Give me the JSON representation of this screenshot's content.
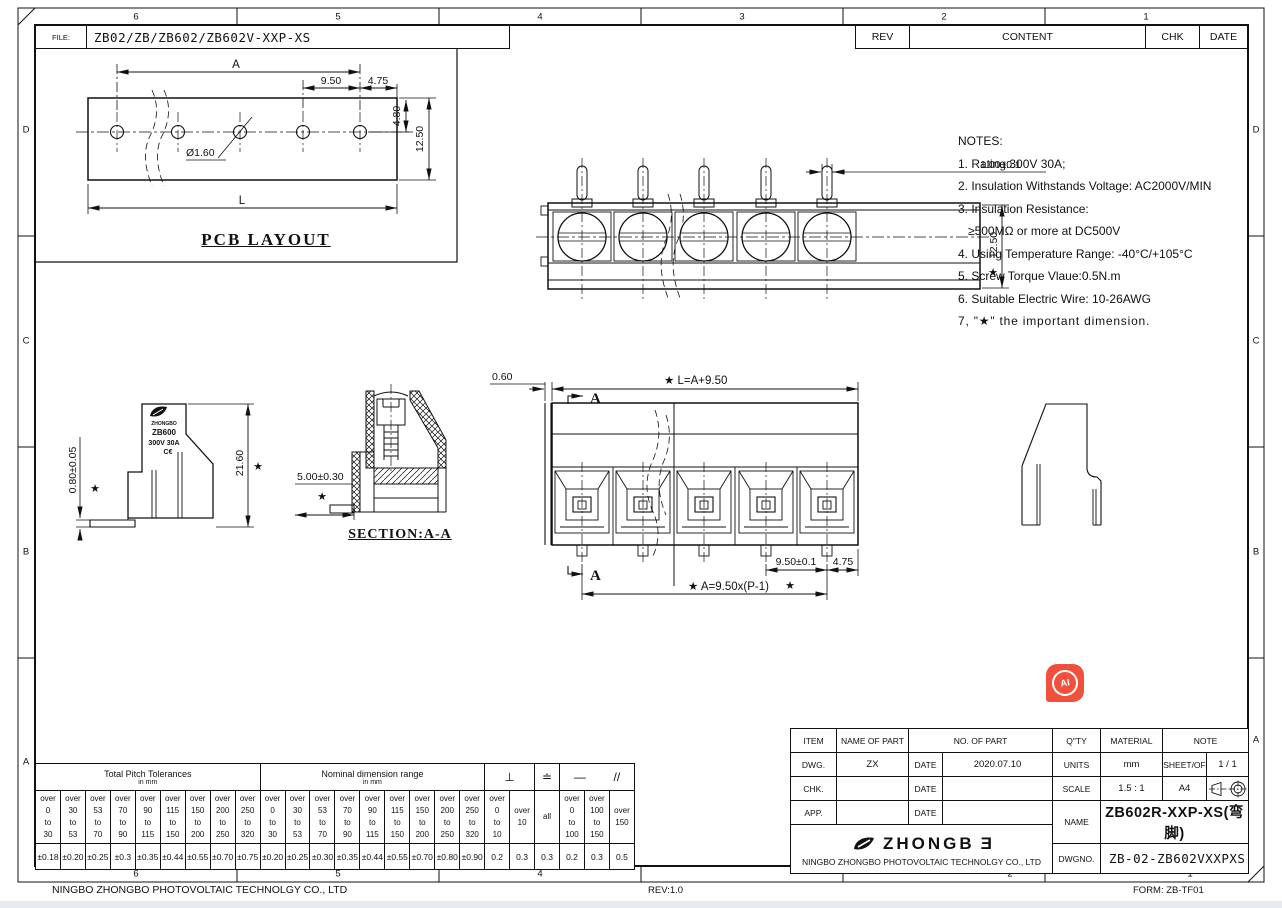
{
  "sheet": {
    "file_label": "FILE:",
    "file_value": "ZB02/ZB/ZB602/ZB602V-XXP-XS",
    "rev": "REV",
    "content": "CONTENT",
    "chk": "CHK",
    "date": "DATE",
    "zone_cols": [
      "6",
      "5",
      "4",
      "3",
      "2",
      "1"
    ],
    "zone_cols_bottom": [
      "6",
      "5",
      "4",
      "2",
      "1"
    ],
    "zone_rows": [
      "D",
      "C",
      "B",
      "A"
    ],
    "footer_company": "NINGBO ZHONGBO PHOTOVOLTAIC TECHNOLGY CO., LTD",
    "footer_rev": "REV:1.0",
    "footer_form": "FORM: ZB-TF01"
  },
  "pcb": {
    "title": "PCB LAYOUT",
    "dim_a": "A",
    "dim_pitch": "9.50",
    "dim_end": "4.75",
    "dim_offset": "4.80",
    "dim_width": "12.50",
    "dim_hole": "Ø1.60",
    "dim_len": "L"
  },
  "top_view": {
    "dim_pin": "1.00±0.1",
    "dim_width": "12.50"
  },
  "side_view": {
    "dim_height": "21.60",
    "dim_pin": "0.80±0.05",
    "dim_offset": "5.00±0.30",
    "brand_name": "ZHONGBO",
    "brand_model": "ZB600",
    "brand_rating": "300V 30A",
    "brand_ce": "C€"
  },
  "section_view": {
    "title": "SECTION:A-A"
  },
  "front_view": {
    "dim_wall": "0.60",
    "dim_len": "★ L=A+9.50",
    "dim_pitch": "9.50±0.1",
    "dim_end": "4.75",
    "dim_formula": "★ A=9.50x(P-1)",
    "mark_a": "A"
  },
  "notes": {
    "title": "NOTES:",
    "n1": "1. Rating:300V 30A;",
    "n2": "2. Insulation Withstands Voltage: AC2000V/MIN",
    "n3": "3. Insulation Resistance:",
    "n3b": "≥500MΩ or more at DC500V",
    "n4": "4. Using Temperature Range: -40°C/+105°C",
    "n5": "5. Screw Torque Vlaue:0.5N.m",
    "n6": "6. Suitable Electric Wire: 10-26AWG",
    "n7": "7, \"★\" the important dimension."
  },
  "tol": {
    "h1": "Total Pitch Tolerances",
    "h1s": "in mm",
    "h2": "Nominal dimension range",
    "h2s": "in mm",
    "s_perp": "⊥",
    "s_flat": "≐",
    "s_dash": "—",
    "s_par": "//",
    "cols": [
      [
        "over",
        "0",
        "to",
        "30"
      ],
      [
        "over",
        "30",
        "to",
        "53"
      ],
      [
        "over",
        "53",
        "to",
        "70"
      ],
      [
        "over",
        "70",
        "to",
        "90"
      ],
      [
        "over",
        "90",
        "to",
        "115"
      ],
      [
        "over",
        "115",
        "to",
        "150"
      ],
      [
        "over",
        "150",
        "to",
        "200"
      ],
      [
        "over",
        "200",
        "to",
        "250"
      ],
      [
        "over",
        "250",
        "to",
        "320"
      ],
      [
        "over",
        "0",
        "to",
        "30"
      ],
      [
        "over",
        "30",
        "to",
        "53"
      ],
      [
        "over",
        "53",
        "to",
        "70"
      ],
      [
        "over",
        "70",
        "to",
        "90"
      ],
      [
        "over",
        "90",
        "to",
        "115"
      ],
      [
        "over",
        "115",
        "to",
        "150"
      ],
      [
        "over",
        "150",
        "to",
        "200"
      ],
      [
        "over",
        "200",
        "to",
        "250"
      ],
      [
        "over",
        "250",
        "to",
        "320"
      ],
      [
        "over",
        "0",
        "to",
        "10"
      ],
      [
        "over",
        "10"
      ],
      [
        "all"
      ],
      [
        "over",
        "0",
        "to",
        "100"
      ],
      [
        "over",
        "100",
        "to",
        "150"
      ],
      [
        "over",
        "150"
      ]
    ],
    "vals": [
      "±0.18",
      "±0.20",
      "±0.25",
      "±0.3",
      "±0.35",
      "±0.44",
      "±0.55",
      "±0.70",
      "±0.75",
      "±0.20",
      "±0.25",
      "±0.30",
      "±0.35",
      "±0.44",
      "±0.55",
      "±0.70",
      "±0.80",
      "±0.90",
      "0.2",
      "0.3",
      "0.3",
      "0.2",
      "0.3",
      "0.5"
    ]
  },
  "tb": {
    "item": "ITEM",
    "name_of_part": "NAME OF PART",
    "no_of_part": "NO. OF PART",
    "qty": "Q\"TY",
    "material": "MATERIAL",
    "note": "NOTE",
    "dwg": "DWG.",
    "dwg_by": "ZX",
    "date": "DATE",
    "dwg_date": "2020.07.10",
    "units": "UNITS",
    "units_val": "mm",
    "sheet_of": "SHEET/OF",
    "sheet_val": "1 /  1",
    "chk": "CHK.",
    "scale": "SCALE",
    "scale_val": "1.5 : 1",
    "paper": "A4",
    "app": "APP.",
    "name": "NAME",
    "name_val": "ZB602R-XXP-XS(弯脚)",
    "brand": "ZHONGB",
    "brand_o": "Ǝ",
    "company": "NINGBO ZHONGBO PHOTOVOLTAIC TECHNOLGY CO., LTD",
    "dwgno": "DWGNO.",
    "dwgno_val": "ZB-02-ZB602VXXPXS"
  },
  "misc": {
    "star": "★",
    "ai": "AI"
  },
  "colors": {
    "ai_badge": "#F0503C",
    "line": "#111111"
  }
}
